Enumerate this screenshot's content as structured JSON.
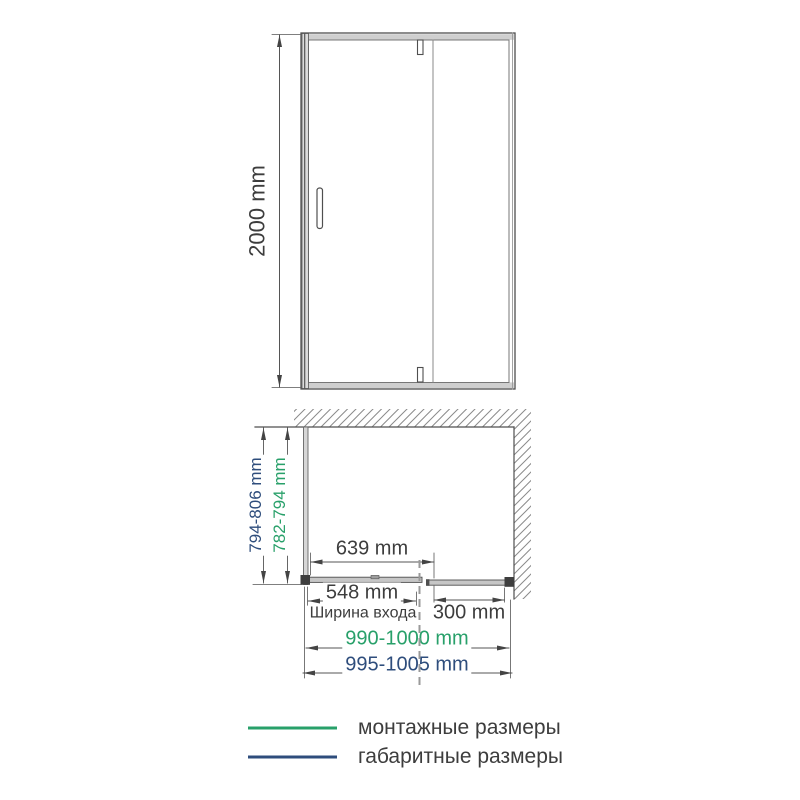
{
  "front_view": {
    "height_dim": "2000 mm"
  },
  "plan_view": {
    "depth_overall_dim": "794-806 mm",
    "depth_mounting_dim": "782-794 mm",
    "glass_width_dim": "639 mm",
    "entrance_width_dim": "548 mm",
    "entrance_width_caption": "Ширина входа",
    "fixed_panel_dim": "300 mm",
    "width_mounting_dim": "990-1000 mm",
    "width_overall_dim": "995-1005 mm"
  },
  "legend": {
    "mounting_label": "монтажные размеры",
    "overall_label": "габаритные размеры",
    "mounting_color": "#28a06a",
    "overall_color": "#2e4d7c"
  }
}
